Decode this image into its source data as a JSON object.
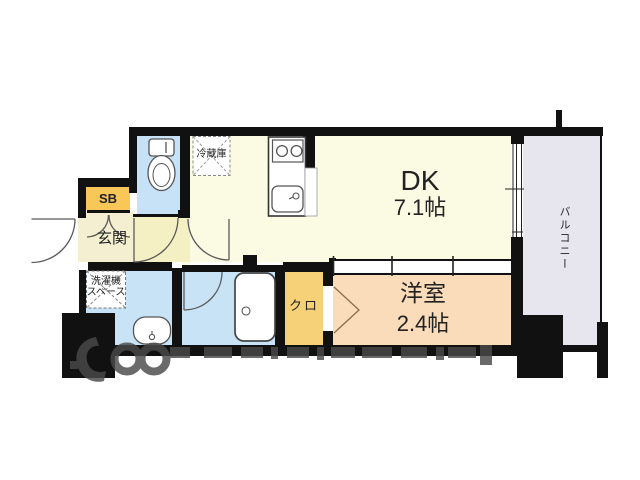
{
  "rooms": {
    "dk": {
      "name": "DK",
      "area": "7.1帖"
    },
    "western_room": {
      "name": "洋室",
      "area": "2.4帖"
    },
    "balcony": {
      "name": "バルコニー"
    },
    "entrance": {
      "name": "玄関"
    },
    "shoe_box": {
      "name": "SB"
    },
    "closet": {
      "name": "クロ"
    },
    "laundry_space": {
      "line1": "洗濯機",
      "line2": "スペース"
    },
    "refrigerator": {
      "name": "冷蔵庫"
    }
  },
  "colors": {
    "wall": "#111111",
    "dk_floor": "#FBFAE2",
    "hall_floor": "#F4F0C4",
    "entrance_floor": "#F3EFD0",
    "toilet_floor": "#C7E2F6",
    "bathroom_floor": "#C9E3F6",
    "washroom_floor": "#C9E3F6",
    "western_room_floor": "#FADCBB",
    "closet_floor": "#F7D177",
    "shoe_box_fill": "#F8C758",
    "balcony_floor": "#E7E5ED",
    "watermark": "#4A4A4A"
  }
}
